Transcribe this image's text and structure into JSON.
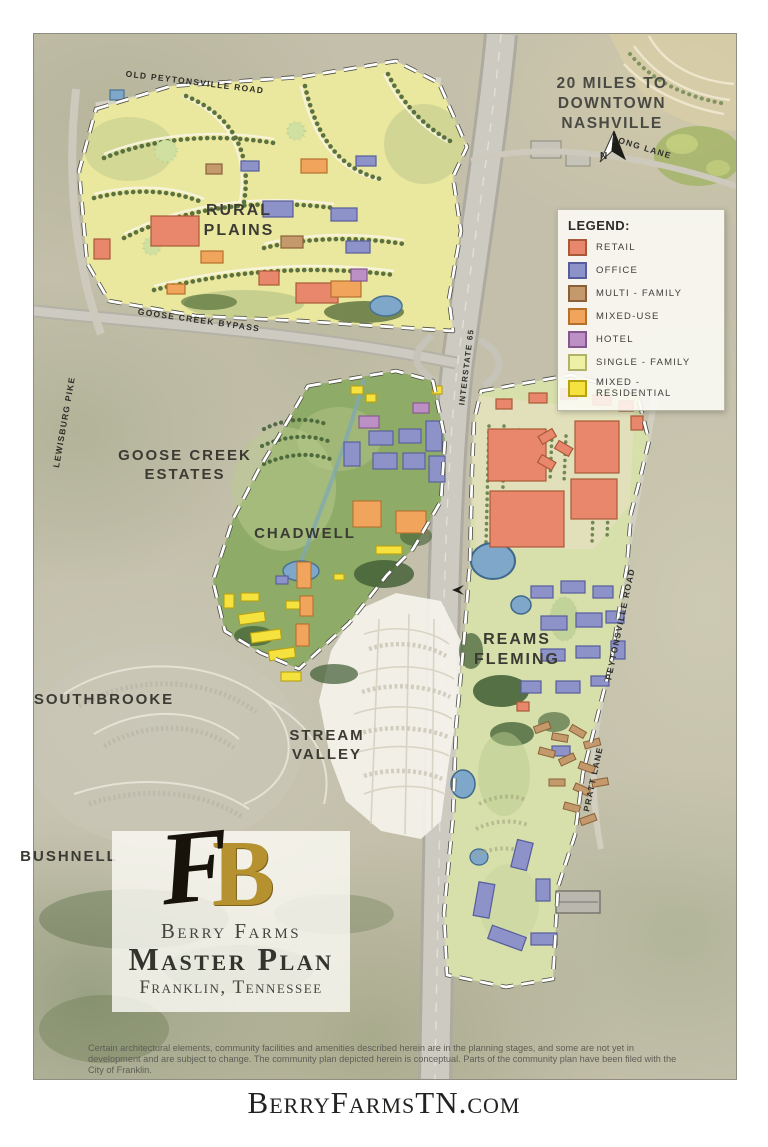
{
  "distance_note": {
    "line1": "20 MILES TO",
    "line2": "DOWNTOWN",
    "line3": "NASHVILLE"
  },
  "compass": {
    "label": "N"
  },
  "legend": {
    "title": "LEGEND:",
    "items": [
      {
        "label": "RETAIL",
        "color": "#e8876b",
        "border": "#a85a38"
      },
      {
        "label": "OFFICE",
        "color": "#8d93c9",
        "border": "#565c9c"
      },
      {
        "label": "MULTI - FAMILY",
        "color": "#c49a6c",
        "border": "#8a6038"
      },
      {
        "label": "MIXED-USE",
        "color": "#f0a45c",
        "border": "#b5712c"
      },
      {
        "label": "HOTEL",
        "color": "#bd90c5",
        "border": "#84578e"
      },
      {
        "label": "SINGLE - FAMILY",
        "color": "#eef0a5",
        "border": "#b1b36a"
      },
      {
        "label": "MIXED - RESIDENTIAL",
        "color": "#f5e23e",
        "border": "#b7a214"
      }
    ]
  },
  "areas": {
    "rural_plains": {
      "line1": "RURAL",
      "line2": "PLAINS"
    },
    "goose_creek_estates": {
      "line1": "GOOSE CREEK",
      "line2": "ESTATES"
    },
    "chadwell": {
      "label": "CHADWELL"
    },
    "southbrooke": {
      "label": "SOUTHBROOKE"
    },
    "stream_valley": {
      "line1": "STREAM",
      "line2": "VALLEY"
    },
    "bushnell": {
      "label": "BUSHNELL"
    },
    "reams_fleming": {
      "line1": "REAMS",
      "line2": "FLEMING"
    }
  },
  "roads": {
    "old_peytonsville_road": "OLD PEYTONSVILLE ROAD",
    "lewisburg_pike": "LEWISBURG PIKE",
    "goose_creek_bypass": "GOOSE CREEK BYPASS",
    "interstate_65": "INTERSTATE 65",
    "long_lane": "LONG LANE",
    "peytonsville_road": "PEYTONSVILLE ROAD",
    "pratt_lane": "PRATT LANE"
  },
  "branding": {
    "monogram_b": "B",
    "monogram_f": "F",
    "name": "Berry Farms",
    "plan_title": "Master Plan",
    "location": "Franklin, Tennessee"
  },
  "disclaimer": "Certain architectural elements, community facilities and amenities described herein are in the planning stages, and some are not yet in development and are subject to change. The community plan depicted herein is conceptual. Parts of the community plan have been filed with the City of Franklin.",
  "footer": {
    "url": "BerryFarmsTN.com"
  }
}
